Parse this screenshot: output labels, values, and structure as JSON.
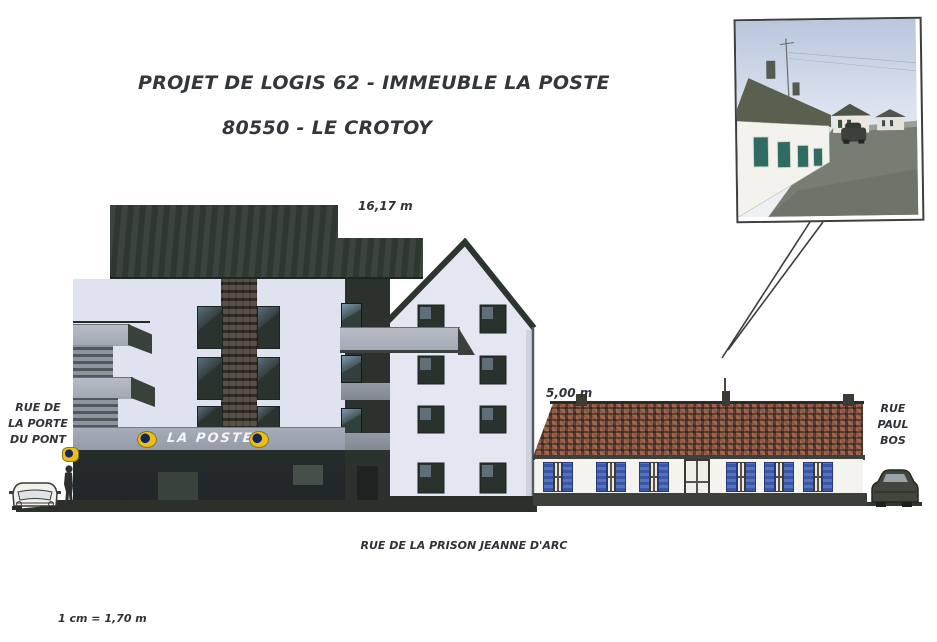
{
  "page": {
    "title_line1": "PROJET DE LOGIS 62 - IMMEUBLE LA POSTE",
    "title_line2": "80550 - LE CROTOY",
    "scale_note": "1 cm = 1,70 m"
  },
  "annotations": {
    "building_height": "16,17 m",
    "house_height": "5,00 m"
  },
  "streets": {
    "left_line1": "RUE DE",
    "left_line2": "LA PORTE",
    "left_line3": "DU PONT",
    "right_line1": "RUE",
    "right_line2": "PAUL",
    "right_line3": "BOS",
    "bottom": "RUE DE LA PRISON JEANNE D'ARC"
  },
  "signage": {
    "la_poste": "LA POSTE"
  },
  "colors": {
    "roof_dark": "#333d35",
    "facade_light": "#dfe3ef",
    "house_roof_red": "#8c5a4b",
    "shutter_blue": "#4160ae",
    "logo_yellow": "#e9bd1f",
    "sign_band_gray": "#9ca2ae"
  }
}
